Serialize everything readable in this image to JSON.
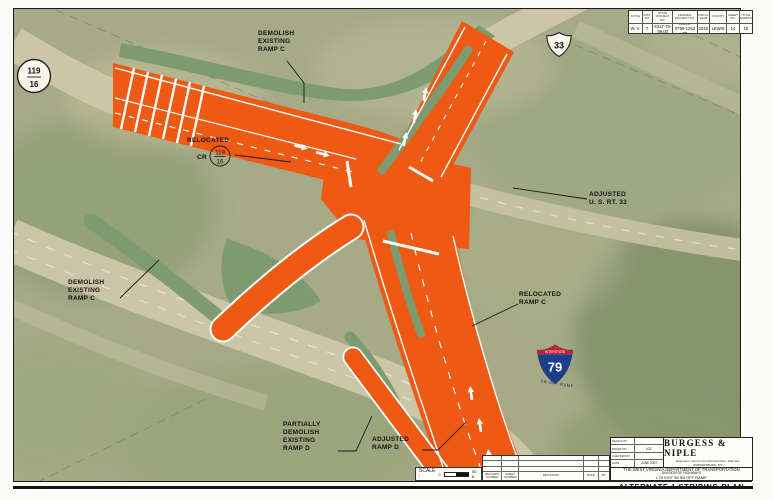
{
  "drawing_labels": {
    "demolish_existing_ramp_c_top": "DEMOLISH\nEXISTING\nRAMP C",
    "relocated": "RELOCATED",
    "cr": "CR",
    "adjusted_us_rt_33": "ADJUSTED\nU. S. RT. 33",
    "demolish_existing_ramp_c_left": "DEMOLISH\nEXISTING\nRAMP C",
    "relocated_ramp_c": "RELOCATED\nRAMP C",
    "partially_demolish_existing_ramp_d": "PARTIALLY\nDEMOLISH\nEXISTING\nRAMP D",
    "adjusted_ramp_d": "ADJUSTED\nRAMP D"
  },
  "shields": {
    "us_route_33": "33",
    "county_route_top": "119",
    "county_route_bottom": "16",
    "interstate_banner": "INTERSTATE",
    "interstate_number": "79",
    "interstate_caption": "SB OFF RAMP"
  },
  "project_table": {
    "columns": [
      {
        "header": "STATE",
        "value": "W. V."
      },
      {
        "header": "DIST. NO.",
        "value": "7"
      },
      {
        "header": "STATE PROJECT NO.",
        "value": "S317-79-99.00"
      },
      {
        "header": "FEDERAL PROJECT NO.",
        "value": "99999-0799-1253 00"
      },
      {
        "header": "FISCAL YEAR",
        "value": "2018"
      },
      {
        "header": "COUNTY",
        "value": "LEWIS"
      },
      {
        "header": "SHEET NO.",
        "value": "14"
      },
      {
        "header": "TOTAL SHEETS",
        "value": "15"
      }
    ]
  },
  "scale_bar": {
    "label": "SCALE :",
    "start": "0",
    "end": "50 ft"
  },
  "revision_table": {
    "headers": [
      "REVISION NUMBER",
      "SHEET NUMBER",
      "REVISIONS",
      "DATE",
      "BY"
    ]
  },
  "firm_block": {
    "design_by_label": "DESIGN BY",
    "design_by_value": "",
    "drawn_by_label": "DRAWN BY",
    "drawn_by_value": "LGC",
    "checked_by_label": "CHECKED BY",
    "checked_by_value": "",
    "date_label": "DATE",
    "date_value": "JUNE 2007",
    "firm_name": "BURGESS & NIPLE",
    "firm_tagline": "Engineers • Environmental Scientists • Planners",
    "firm_location": "PARKERSBURG, WV",
    "agency": "THE WEST VIRGINIA DEPARTMENT OF TRANSPORTATION",
    "division": "DIVISION OF HIGHWAYS",
    "project_name": "I-79 EXIT 99 SB OFF RAMP",
    "sheet_title": "ALTERNATE 1 STRIPING PLAN"
  },
  "colors": {
    "highlight_orange": "#ee5a14",
    "median_green": "#7d9a70",
    "aerial_base": "#a6aa87"
  }
}
